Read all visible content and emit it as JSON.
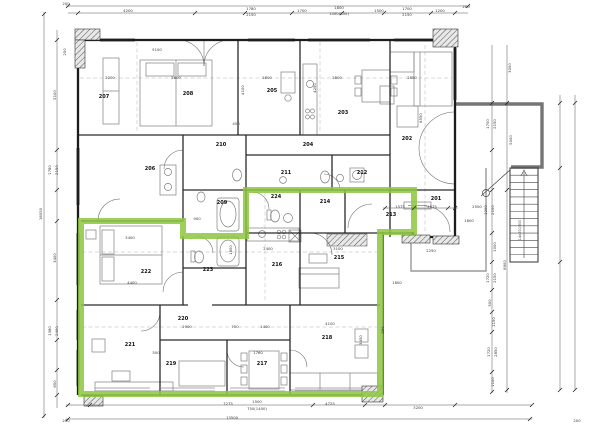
{
  "title": "Floor plan – level 2 with highlighted apartment",
  "colors": {
    "highlight_green": "#8dc63f",
    "wall_black": "#1c1c1c",
    "terrace_gray": "#757575",
    "furniture_gray": "#808080",
    "dim_gray": "#3a3a3a"
  },
  "rooms": [
    {
      "label": "201",
      "x": 436,
      "y": 200
    },
    {
      "label": "202",
      "x": 407,
      "y": 140
    },
    {
      "label": "203",
      "x": 343,
      "y": 114
    },
    {
      "label": "204",
      "x": 308,
      "y": 146
    },
    {
      "label": "205",
      "x": 272,
      "y": 92
    },
    {
      "label": "206",
      "x": 150,
      "y": 170
    },
    {
      "label": "207",
      "x": 104,
      "y": 98
    },
    {
      "label": "208",
      "x": 188,
      "y": 95
    },
    {
      "label": "209",
      "x": 222,
      "y": 204
    },
    {
      "label": "210",
      "x": 221,
      "y": 146
    },
    {
      "label": "211",
      "x": 286,
      "y": 174
    },
    {
      "label": "212",
      "x": 362,
      "y": 174
    },
    {
      "label": "213",
      "x": 391,
      "y": 216
    },
    {
      "label": "214",
      "x": 325,
      "y": 203
    },
    {
      "label": "215",
      "x": 339,
      "y": 259
    },
    {
      "label": "216",
      "x": 277,
      "y": 266
    },
    {
      "label": "217",
      "x": 262,
      "y": 365
    },
    {
      "label": "218",
      "x": 327,
      "y": 339
    },
    {
      "label": "219",
      "x": 171,
      "y": 365
    },
    {
      "label": "220",
      "x": 183,
      "y": 320
    },
    {
      "label": "221",
      "x": 130,
      "y": 346
    },
    {
      "label": "222",
      "x": 146,
      "y": 273
    },
    {
      "label": "223",
      "x": 208,
      "y": 271
    },
    {
      "label": "224",
      "x": 276,
      "y": 198
    }
  ],
  "dims": [
    {
      "t": "200",
      "x": 66,
      "y": 5
    },
    {
      "t": "4200",
      "x": 128,
      "y": 12
    },
    {
      "t": "1780",
      "x": 251,
      "y": 10
    },
    {
      "t": "2150",
      "x": 251,
      "y": 16
    },
    {
      "t": "1700",
      "x": 302,
      "y": 12
    },
    {
      "t": "1800",
      "x": 339,
      "y": 9
    },
    {
      "t": "1500(850)",
      "x": 339,
      "y": 15
    },
    {
      "t": "1500",
      "x": 379,
      "y": 12
    },
    {
      "t": "1700",
      "x": 407,
      "y": 10
    },
    {
      "t": "2150",
      "x": 407,
      "y": 16
    },
    {
      "t": "1200",
      "x": 440,
      "y": 12
    },
    {
      "t": "200",
      "x": 466,
      "y": 8
    },
    {
      "t": "250",
      "x": 66,
      "y": 52,
      "r": 1
    },
    {
      "t": "5100",
      "x": 56,
      "y": 95,
      "r": 1
    },
    {
      "t": "1780",
      "x": 51,
      "y": 170,
      "r": 1
    },
    {
      "t": "2150",
      "x": 58,
      "y": 170,
      "r": 1
    },
    {
      "t": "16050",
      "x": 42,
      "y": 214,
      "r": 1
    },
    {
      "t": "3400",
      "x": 56,
      "y": 258,
      "r": 1
    },
    {
      "t": "1380",
      "x": 51,
      "y": 331,
      "r": 1
    },
    {
      "t": "2400",
      "x": 58,
      "y": 331,
      "r": 1
    },
    {
      "t": "650",
      "x": 56,
      "y": 384,
      "r": 1
    },
    {
      "t": "7275",
      "x": 228,
      "y": 405
    },
    {
      "t": "1500",
      "x": 257,
      "y": 403
    },
    {
      "t": "750(1400)",
      "x": 257,
      "y": 410
    },
    {
      "t": "4725",
      "x": 330,
      "y": 405
    },
    {
      "t": "3200",
      "x": 418,
      "y": 409
    },
    {
      "t": "13500",
      "x": 232,
      "y": 419
    },
    {
      "t": "200",
      "x": 66,
      "y": 422
    },
    {
      "t": "200",
      "x": 577,
      "y": 422
    },
    {
      "t": "3000",
      "x": 511,
      "y": 68,
      "r": 1
    },
    {
      "t": "1700",
      "x": 489,
      "y": 124,
      "r": 1
    },
    {
      "t": "2150",
      "x": 496,
      "y": 124,
      "r": 1
    },
    {
      "t": "5000",
      "x": 512,
      "y": 140,
      "r": 1
    },
    {
      "t": "1200",
      "x": 487,
      "y": 210,
      "r": 1
    },
    {
      "t": "2150",
      "x": 494,
      "y": 210,
      "r": 1
    },
    {
      "t": "1000",
      "x": 496,
      "y": 247,
      "r": 1
    },
    {
      "t": "8900",
      "x": 506,
      "y": 265,
      "r": 1
    },
    {
      "t": "1720",
      "x": 489,
      "y": 278,
      "r": 1
    },
    {
      "t": "2150",
      "x": 496,
      "y": 278,
      "r": 1
    },
    {
      "t": "500",
      "x": 491,
      "y": 303,
      "r": 1
    },
    {
      "t": "1150",
      "x": 495,
      "y": 322,
      "r": 1
    },
    {
      "t": "1720",
      "x": 490,
      "y": 352,
      "r": 1
    },
    {
      "t": "2850",
      "x": 497,
      "y": 352,
      "r": 1
    },
    {
      "t": "1100",
      "x": 494,
      "y": 382,
      "r": 1
    },
    {
      "t": "5100",
      "x": 157,
      "y": 51
    },
    {
      "t": "2200",
      "x": 110,
      "y": 79
    },
    {
      "t": "2800",
      "x": 176,
      "y": 79
    },
    {
      "t": "2800",
      "x": 267,
      "y": 79
    },
    {
      "t": "2800",
      "x": 337,
      "y": 79
    },
    {
      "t": "2850",
      "x": 412,
      "y": 79
    },
    {
      "t": "450",
      "x": 236,
      "y": 125
    },
    {
      "t": "4100",
      "x": 244,
      "y": 90,
      "r": 1
    },
    {
      "t": "4250",
      "x": 316,
      "y": 88,
      "r": 1
    },
    {
      "t": "6550",
      "x": 422,
      "y": 118,
      "r": 1
    },
    {
      "t": "3400",
      "x": 130,
      "y": 239
    },
    {
      "t": "4400",
      "x": 132,
      "y": 284
    },
    {
      "t": "2400",
      "x": 268,
      "y": 250
    },
    {
      "t": "3100",
      "x": 338,
      "y": 250
    },
    {
      "t": "1575",
      "x": 400,
      "y": 208
    },
    {
      "t": "1575",
      "x": 432,
      "y": 208
    },
    {
      "t": "2500",
      "x": 477,
      "y": 208
    },
    {
      "t": "1800",
      "x": 469,
      "y": 222
    },
    {
      "t": "2250",
      "x": 431,
      "y": 252
    },
    {
      "t": "1800",
      "x": 397,
      "y": 284
    },
    {
      "t": "900",
      "x": 197,
      "y": 220
    },
    {
      "t": "1800",
      "x": 232,
      "y": 250,
      "r": 1
    },
    {
      "t": "750",
      "x": 235,
      "y": 328
    },
    {
      "t": "1400",
      "x": 265,
      "y": 328
    },
    {
      "t": "2900",
      "x": 187,
      "y": 328
    },
    {
      "t": "1760",
      "x": 258,
      "y": 354
    },
    {
      "t": "500",
      "x": 156,
      "y": 354
    },
    {
      "t": "3450",
      "x": 362,
      "y": 340,
      "r": 1
    },
    {
      "t": "4100",
      "x": 330,
      "y": 325
    },
    {
      "t": "290",
      "x": 384,
      "y": 330,
      "r": 1
    }
  ],
  "notes": [
    {
      "t": "14x200/300",
      "x": 521,
      "y": 230,
      "r": 1
    }
  ]
}
